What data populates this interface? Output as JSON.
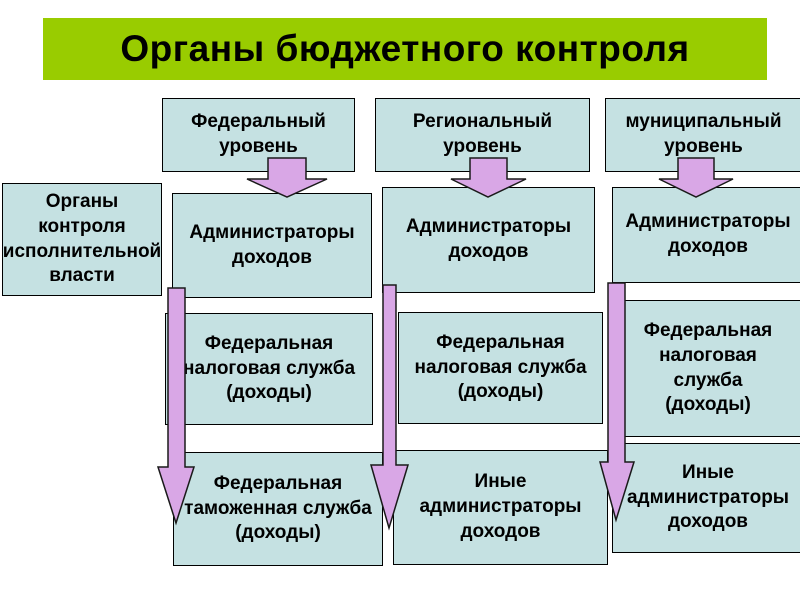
{
  "slide": {
    "title": "Органы бюджетного контроля",
    "colors": {
      "title_background": "#99CC00",
      "box_fill": "#C5E1E2",
      "box_border": "#000000",
      "arrow_fill": "#D9A7E6",
      "arrow_outline": "#1A1A1A",
      "slide_background": "#FFFFFF",
      "text": "#000000"
    },
    "side_box": {
      "label": "Органы\nконтроля\nисполнительной\nвласти"
    },
    "columns": [
      {
        "header": "Федеральный\nуровень",
        "boxes": [
          "Администраторы\nдоходов",
          "Федеральная\nналоговая служба\n(доходы)",
          "Федеральная\nтаможенная служба\n(доходы)"
        ]
      },
      {
        "header": "Региональный\nуровень",
        "boxes": [
          "Администраторы\nдоходов",
          "Федеральная\nналоговая служба\n(доходы)",
          "Иные\nадминистраторы\nдоходов"
        ]
      },
      {
        "header": "муниципальный\nуровень",
        "boxes": [
          "Администраторы\nдоходов",
          "Федеральная\nналоговая\nслужба\n(доходы)",
          "Иные\nадминистраторы\nдоходов"
        ]
      }
    ]
  }
}
